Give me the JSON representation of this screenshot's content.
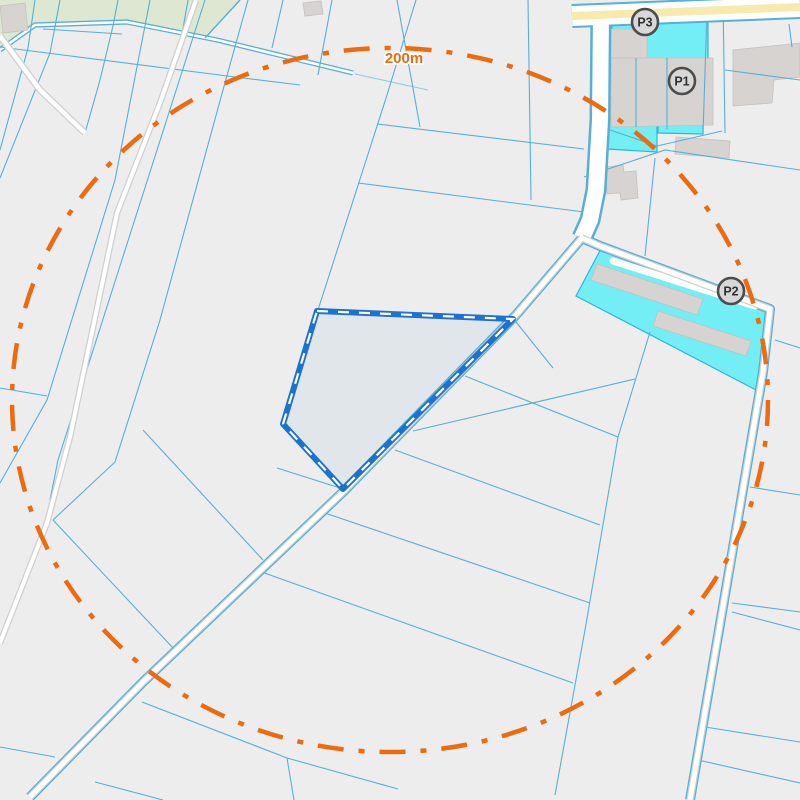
{
  "map": {
    "background": "#ededed",
    "colors": {
      "parcel_line": "#56b0d6",
      "parcel_line_light": "#8fcbe2",
      "green": "#dde7d2",
      "cyan": "#73eef4",
      "cyan_border": "#2fb6d8",
      "building": "#d6d3d0",
      "building_border": "#c4c1be",
      "road_casing": "#cfcfcf",
      "road_fill": "#ffffff",
      "highway_fill": "#f8e9ad",
      "selected_stroke": "#1b73cf",
      "selected_dash": "#ffffff",
      "radius_color": "#ed6b0e",
      "marker_fill": "#d8d8d8",
      "marker_stroke": "#4c4c4c",
      "marker_text": "#303030"
    },
    "green_areas": [
      {
        "points": "0,0 240,0 205,38 127,22 35,25 0,50"
      }
    ],
    "water_areas": [
      {
        "points": "612,13 708,13 708,60 612,60"
      },
      {
        "points": "607,118 657,122 657,152 607,149"
      },
      {
        "points": "658,122 703,124 703,134 658,133"
      },
      {
        "points": "603,245 768,306 756,390 576,296"
      }
    ],
    "buildings": [
      {
        "points": "0,6 25,3 28,30 3,33"
      },
      {
        "points": "303,3 321,1 323,14 305,16"
      },
      {
        "points": "610,29 647,29 647,58 610,58"
      },
      {
        "points": "611,58 713,58 713,125 611,127"
      },
      {
        "points": "676,137 730,141 729,158 675,154"
      },
      {
        "points": "606,167 623,165 624,172 636,171 638,198 621,200 620,193 607,194"
      },
      {
        "points": "733,50 800,43 800,77 774,80 772,103 733,106"
      },
      {
        "points": "597,264 703,299 697,315 591,280"
      },
      {
        "points": "658,311 751,341 746,356 653,326"
      }
    ],
    "canal": {
      "points": "0,50 35,25 127,22 217,40 353,73",
      "edge_width": 5.2,
      "core_width": 2.6
    },
    "parcel_lines": [
      {
        "points": "0,47 243,78 300,85"
      },
      {
        "points": "43,29 122,34"
      },
      {
        "points": "355,74 428,90",
        "light": true
      },
      {
        "points": "118,0 113,26"
      },
      {
        "points": "113,26 100,80 85,133"
      },
      {
        "points": "188,0 182,34"
      },
      {
        "points": "240,0 205,38",
        "w": 1.4
      },
      {
        "points": "35,0 28,48 0,150"
      },
      {
        "points": "60,0 50,53 0,178"
      },
      {
        "points": "283,0 272,48"
      },
      {
        "points": "332,0 318,75"
      },
      {
        "points": "150,0 115,180 47,400 0,483"
      },
      {
        "points": "205,0 173,100 58,460 50,500"
      },
      {
        "points": "248,0 223,90 160,320 115,462 53,520"
      },
      {
        "points": "53,520 173,648"
      },
      {
        "points": "416,0 387,95 318,310"
      },
      {
        "points": "397,0 420,127"
      },
      {
        "points": "377,124 584,149"
      },
      {
        "points": "358,183 584,212"
      },
      {
        "points": "528,0 531,200"
      },
      {
        "points": "650,332 618,437 585,630 555,795"
      },
      {
        "points": "413,431 635,379"
      },
      {
        "points": "465,376 618,437"
      },
      {
        "points": "516,322 553,368"
      },
      {
        "points": "395,450 600,525"
      },
      {
        "points": "322,512 590,603"
      },
      {
        "points": "256,570 573,683"
      },
      {
        "points": "143,430 263,560"
      },
      {
        "points": "277,468 340,488"
      },
      {
        "points": "0,388 47,396"
      },
      {
        "points": "0,747 55,757"
      },
      {
        "points": "95,782 163,800"
      },
      {
        "points": "142,702 287,758 398,789"
      },
      {
        "points": "287,758 294,800"
      },
      {
        "points": "750,487 800,495"
      },
      {
        "points": "732,603 800,612"
      },
      {
        "points": "732,612 800,630"
      },
      {
        "points": "705,727 800,742"
      },
      {
        "points": "698,760 800,783"
      },
      {
        "points": "775,340 800,348"
      },
      {
        "points": "584,177 665,150 800,170"
      },
      {
        "points": "655,158 645,256"
      },
      {
        "points": "610,130 657,146"
      },
      {
        "points": "657,146 722,131"
      },
      {
        "points": "636,58 636,127"
      },
      {
        "points": "667,58 667,129"
      },
      {
        "points": "707,13 703,133"
      },
      {
        "points": "723,0 725,133"
      },
      {
        "points": "725,70 800,80"
      },
      {
        "points": "789,24 792,47"
      },
      {
        "points": "702,0 702,7"
      },
      {
        "points": "715,0 715,6"
      },
      {
        "points": "773,0 773,5"
      }
    ],
    "roads": [
      {
        "name": "highway-road",
        "points": "572,16 800,7",
        "layers": [
          [
            "#56b0d6",
            24
          ],
          [
            "#ffffff",
            20
          ],
          [
            "#f8e9ad",
            8
          ]
        ]
      },
      {
        "name": "corner-road",
        "points": "0,36 40,90 85,133",
        "layers": [
          [
            "#cfcfcf",
            7
          ],
          [
            "#ffffff",
            4.5
          ]
        ]
      },
      {
        "name": "west-road",
        "points": "196,0 160,103 117,213 70,437 47,523 0,643",
        "layers": [
          [
            "#cfcfcf",
            6.5
          ],
          [
            "#ffffff",
            4
          ]
        ]
      },
      {
        "name": "access-road-north",
        "points": "601,13 600,120 596,190 590,220 582,238",
        "layers": [
          [
            "#56b0d6",
            21
          ],
          [
            "#ffffff",
            16
          ]
        ]
      },
      {
        "name": "central-road",
        "points": "582,238 516,315 343,492 143,682 30,797",
        "layers": [
          [
            "#56b0d6",
            10
          ],
          [
            "#cfcfcf",
            7.5
          ],
          [
            "#ffffff",
            5
          ]
        ]
      },
      {
        "name": "east-road",
        "points": "582,238 600,246 770,309 763,372 690,800",
        "layers": [
          [
            "#56b0d6",
            10
          ],
          [
            "#cfcfcf",
            7.5
          ],
          [
            "#ffffff",
            5
          ]
        ]
      },
      {
        "name": "farm-path",
        "points": "613,261 755,306",
        "cap": "round",
        "layers": [
          [
            "#ffffff",
            7
          ]
        ]
      }
    ],
    "selected_parcel": {
      "points": "317,311 513,319 343,489 283,424",
      "fill": "rgba(27,115,207,0.06)",
      "stroke_width": 6,
      "dash_width": 2.2,
      "dash_pattern": "11 10"
    },
    "radius_circle": {
      "cx": 390,
      "cy": 400,
      "rx": 378,
      "ry": 352,
      "stroke_width": 4.5,
      "dash_pattern": "26 15 6 15",
      "label": "200m",
      "label_x": 404,
      "label_y": 63
    },
    "markers": [
      {
        "id": "p1",
        "label": "P1",
        "x": 682,
        "y": 81,
        "r": 13
      },
      {
        "id": "p2",
        "label": "P2",
        "x": 731,
        "y": 291,
        "r": 13
      },
      {
        "id": "p3",
        "label": "P3",
        "x": 645,
        "y": 22,
        "r": 13
      }
    ]
  }
}
